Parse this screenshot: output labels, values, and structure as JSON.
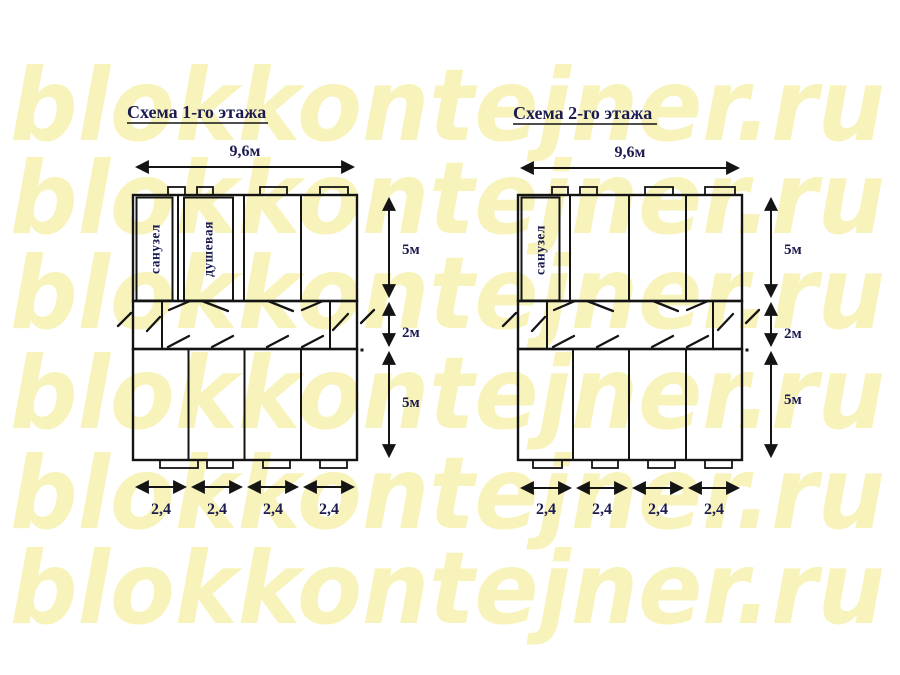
{
  "watermark": {
    "text": "blokkontejner.ru",
    "color": "#f7f3bb",
    "rows": 6
  },
  "colors": {
    "line": "#141414",
    "text": "#1b1b4f",
    "watermark": "#f7f3bb",
    "background": "#ffffff"
  },
  "floor1": {
    "title": "Схема 1-го этажа",
    "width_label": "9,6м",
    "room_labels": {
      "sanuzel": "санузел",
      "dushevaya": "душевая"
    },
    "side_dims": [
      "5м",
      "2м",
      "5м"
    ],
    "bottom_dims": [
      "2,4",
      "2,4",
      "2,4",
      "2,4"
    ]
  },
  "floor2": {
    "title": "Схема 2-го этажа",
    "width_label": "9,6м",
    "room_labels": {
      "sanuzel": "санузел"
    },
    "side_dims": [
      "5м",
      "2м",
      "5м"
    ],
    "bottom_dims": [
      "2,4",
      "2,4",
      "2,4",
      "2,4"
    ]
  }
}
